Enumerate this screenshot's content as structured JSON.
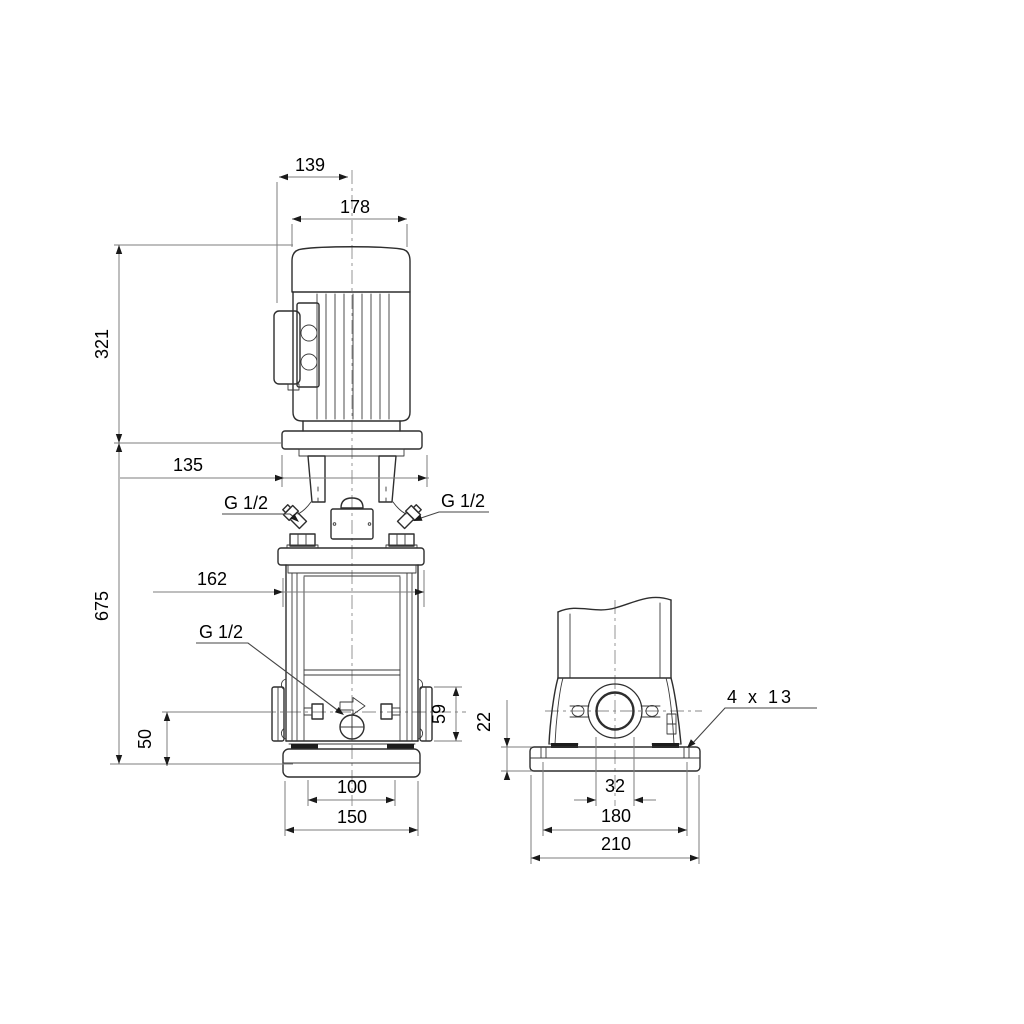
{
  "drawing": {
    "front_view": {
      "dim_terminal_box_to_center": "139",
      "dim_motor_width": "178",
      "dim_motor_height": "321",
      "dim_motor_stool_width": "135",
      "dim_pump_height": "675",
      "dim_head_flange_width": "162",
      "dim_port_center_to_base": "50",
      "dim_port_flange_height": "59",
      "dim_base_bolt_spacing": "100",
      "dim_base_width": "150",
      "label_vent_left": "G 1/2",
      "label_vent_right": "G 1/2",
      "label_drain": "G 1/2"
    },
    "side_view": {
      "dim_base_height": "22",
      "dim_port_bore": "32",
      "dim_base_bolt_spacing": "180",
      "dim_base_width": "210",
      "label_bolt_holes": "4 x 13"
    },
    "colors": {
      "background": "#ffffff",
      "object_line": "#2e2e2e",
      "dimension_line": "#7d7d7d",
      "text": "#000000"
    }
  }
}
